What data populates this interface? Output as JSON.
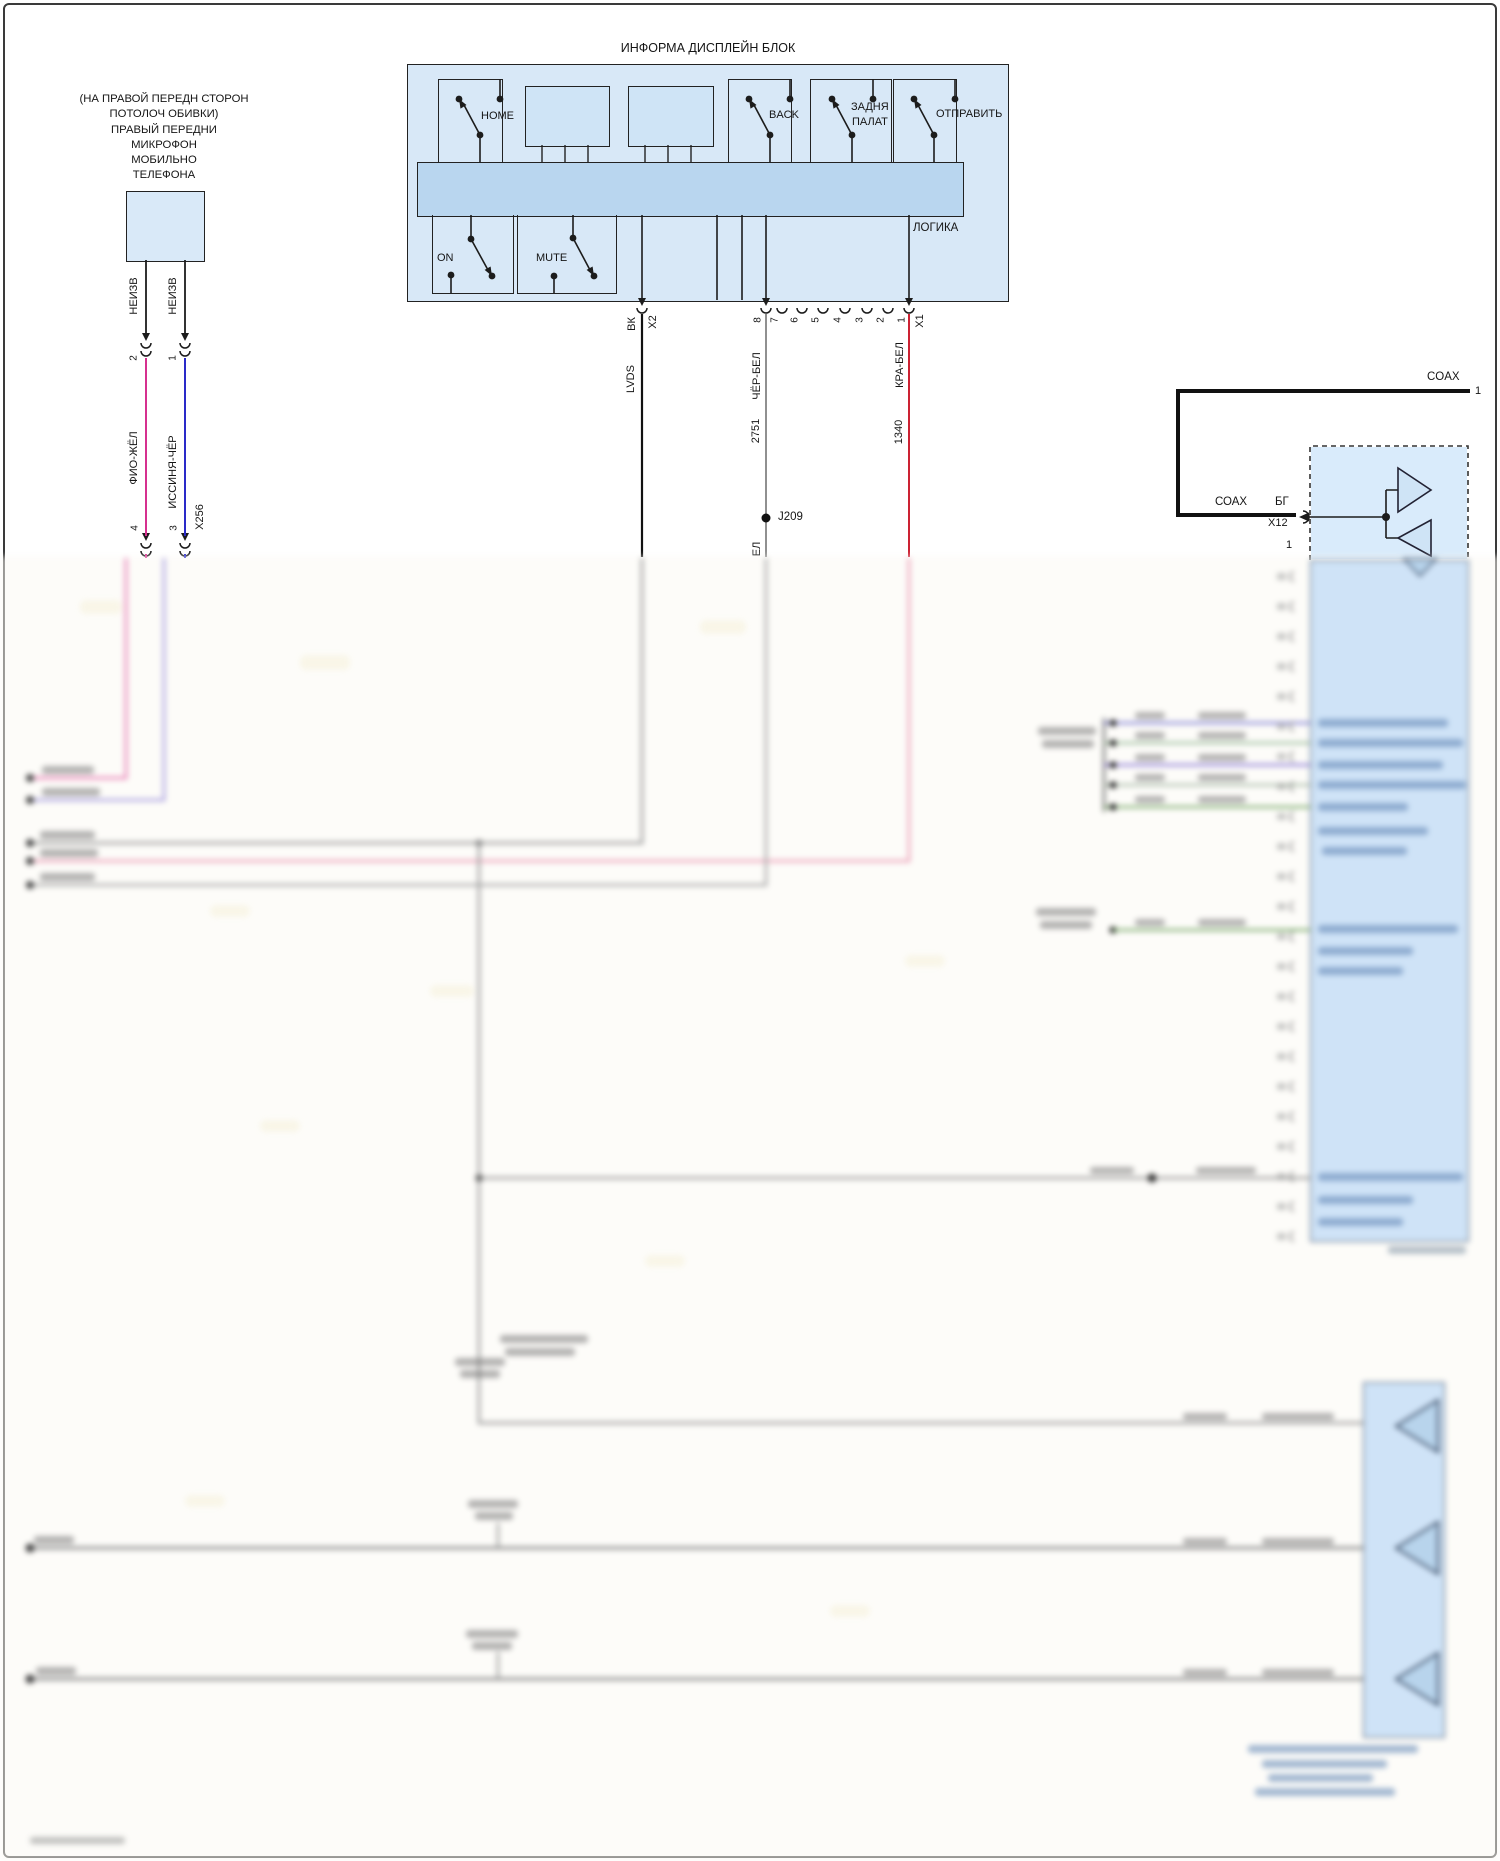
{
  "mic": {
    "note_lines": [
      "(НА ПРАВОЙ ПЕРЕДН СТОРОН",
      "ПОТОЛОЧ ОБИВКИ)",
      "ПРАВЫЙ ПЕРЕДНИ",
      "МИКРОФОН",
      "МОБИЛЬНО",
      "ТЕЛЕФОНА"
    ],
    "wire_top_labels": [
      "НЕИЗВ",
      "НЕИЗВ"
    ],
    "conn1_pins": [
      "2",
      "1"
    ],
    "wire_mid_labels": [
      "ФИО-ЖЁЛ",
      "ИССИНЯ-ЧЁР"
    ],
    "conn2_pins": [
      "4",
      "3"
    ],
    "conn2_name": "X256"
  },
  "display": {
    "title": "ИНФОРМА ДИСПЛЕЙН БЛОК",
    "buttons": {
      "home": "HOME",
      "back": "BACK",
      "rear_line1": "ЗАДНЯ",
      "rear_line2": "ПАЛАТ",
      "send": "ОТПРАВИТЬ",
      "on": "ON",
      "mute": "MUTE"
    },
    "logic": "ЛОГИКА",
    "x2": {
      "wire_color": "ВК",
      "connector": "X2",
      "signal": "LVDS"
    },
    "x1": {
      "pins": [
        "8",
        "7",
        "6",
        "5",
        "4",
        "3",
        "2",
        "1"
      ],
      "connector": "X1",
      "pin8_wire": "ЧЁР-БЕЛ",
      "pin8_circuit": "2751",
      "splice": "J209",
      "pin8_wire_cont_partial": "ЕЛ",
      "pin1_wire": "КРА-БЕЛ",
      "pin1_circuit": "1340"
    }
  },
  "coax": {
    "top_label": "COAX",
    "top_pin": "1",
    "seg_label": "СОАХ",
    "wire_color": "БГ",
    "connector": "X12",
    "pin": "1",
    "signal": "ВИР"
  },
  "colors": {
    "box_fill": "#d8e8f7",
    "inner_bar_fill": "#b9d6ef",
    "keypad_fill": "#cfe4f6",
    "line": "#222222",
    "wire_violet_yellow": "#d6308f",
    "wire_blue_black": "#2a2ac8",
    "wire_black_lvds": "#111111",
    "wire_black_white": "#909090",
    "wire_red_white": "#cc2233",
    "coax_thick": "#111111",
    "blur_pink": "#e87fb5",
    "blur_lavender": "#a89fe0",
    "blur_grey": "#9b9b9b",
    "blur_green": "#7fae6f"
  }
}
